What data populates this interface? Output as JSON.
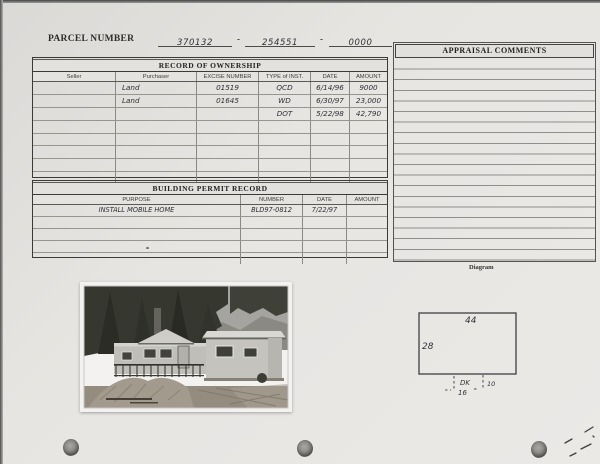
{
  "header": {
    "parcel_label": "PARCEL NUMBER",
    "parcel_parts": [
      "370132",
      "254551",
      "0000"
    ],
    "separator": "-"
  },
  "ownership": {
    "title": "RECORD OF OWNERSHIP",
    "columns": [
      "Seller",
      "Purchaser",
      "EXCISE NUMBER",
      "TYPE of INST.",
      "DATE",
      "AMOUNT"
    ],
    "rows": [
      [
        "",
        "Land",
        "01519",
        "QCD",
        "6/14/96",
        "9000"
      ],
      [
        "",
        "Land",
        "01645",
        "WD",
        "6/30/97",
        "23,000"
      ],
      [
        "",
        "",
        "",
        "DOT",
        "5/22/98",
        "42,790"
      ],
      [
        "",
        "",
        "",
        "",
        "",
        ""
      ],
      [
        "",
        "",
        "",
        "",
        "",
        ""
      ],
      [
        "",
        "",
        "",
        "",
        "",
        ""
      ],
      [
        "",
        "",
        "",
        "",
        "",
        ""
      ],
      [
        "",
        "",
        "",
        "",
        "",
        ""
      ]
    ]
  },
  "building_permit": {
    "title": "BUILDING PERMIT RECORD",
    "columns": [
      "PURPOSE",
      "NUMBER",
      "DATE",
      "AMOUNT"
    ],
    "rows": [
      [
        "INSTALL MOBILE HOME",
        "BLD97-0812",
        "7/22/97",
        ""
      ],
      [
        "",
        "",
        "",
        ""
      ],
      [
        "",
        "",
        "",
        ""
      ],
      [
        "",
        "",
        "",
        ""
      ],
      [
        "",
        "",
        "",
        ""
      ]
    ]
  },
  "appraisal": {
    "title": "APPRAISAL COMMENTS"
  },
  "lower": {
    "diagram_label": "Diagram"
  },
  "diagram": {
    "width": "44",
    "depth": "28",
    "deck_label": "DK",
    "deck_width": "16",
    "deck_depth": "10"
  },
  "photo": {
    "alt": "Manufactured home with front deck, evergreen trees behind, graded dirt and fill mound in foreground"
  },
  "colors": {
    "paper": "#e7e5e2",
    "ink": "#2e2e34",
    "form_line": "#8a8984"
  }
}
